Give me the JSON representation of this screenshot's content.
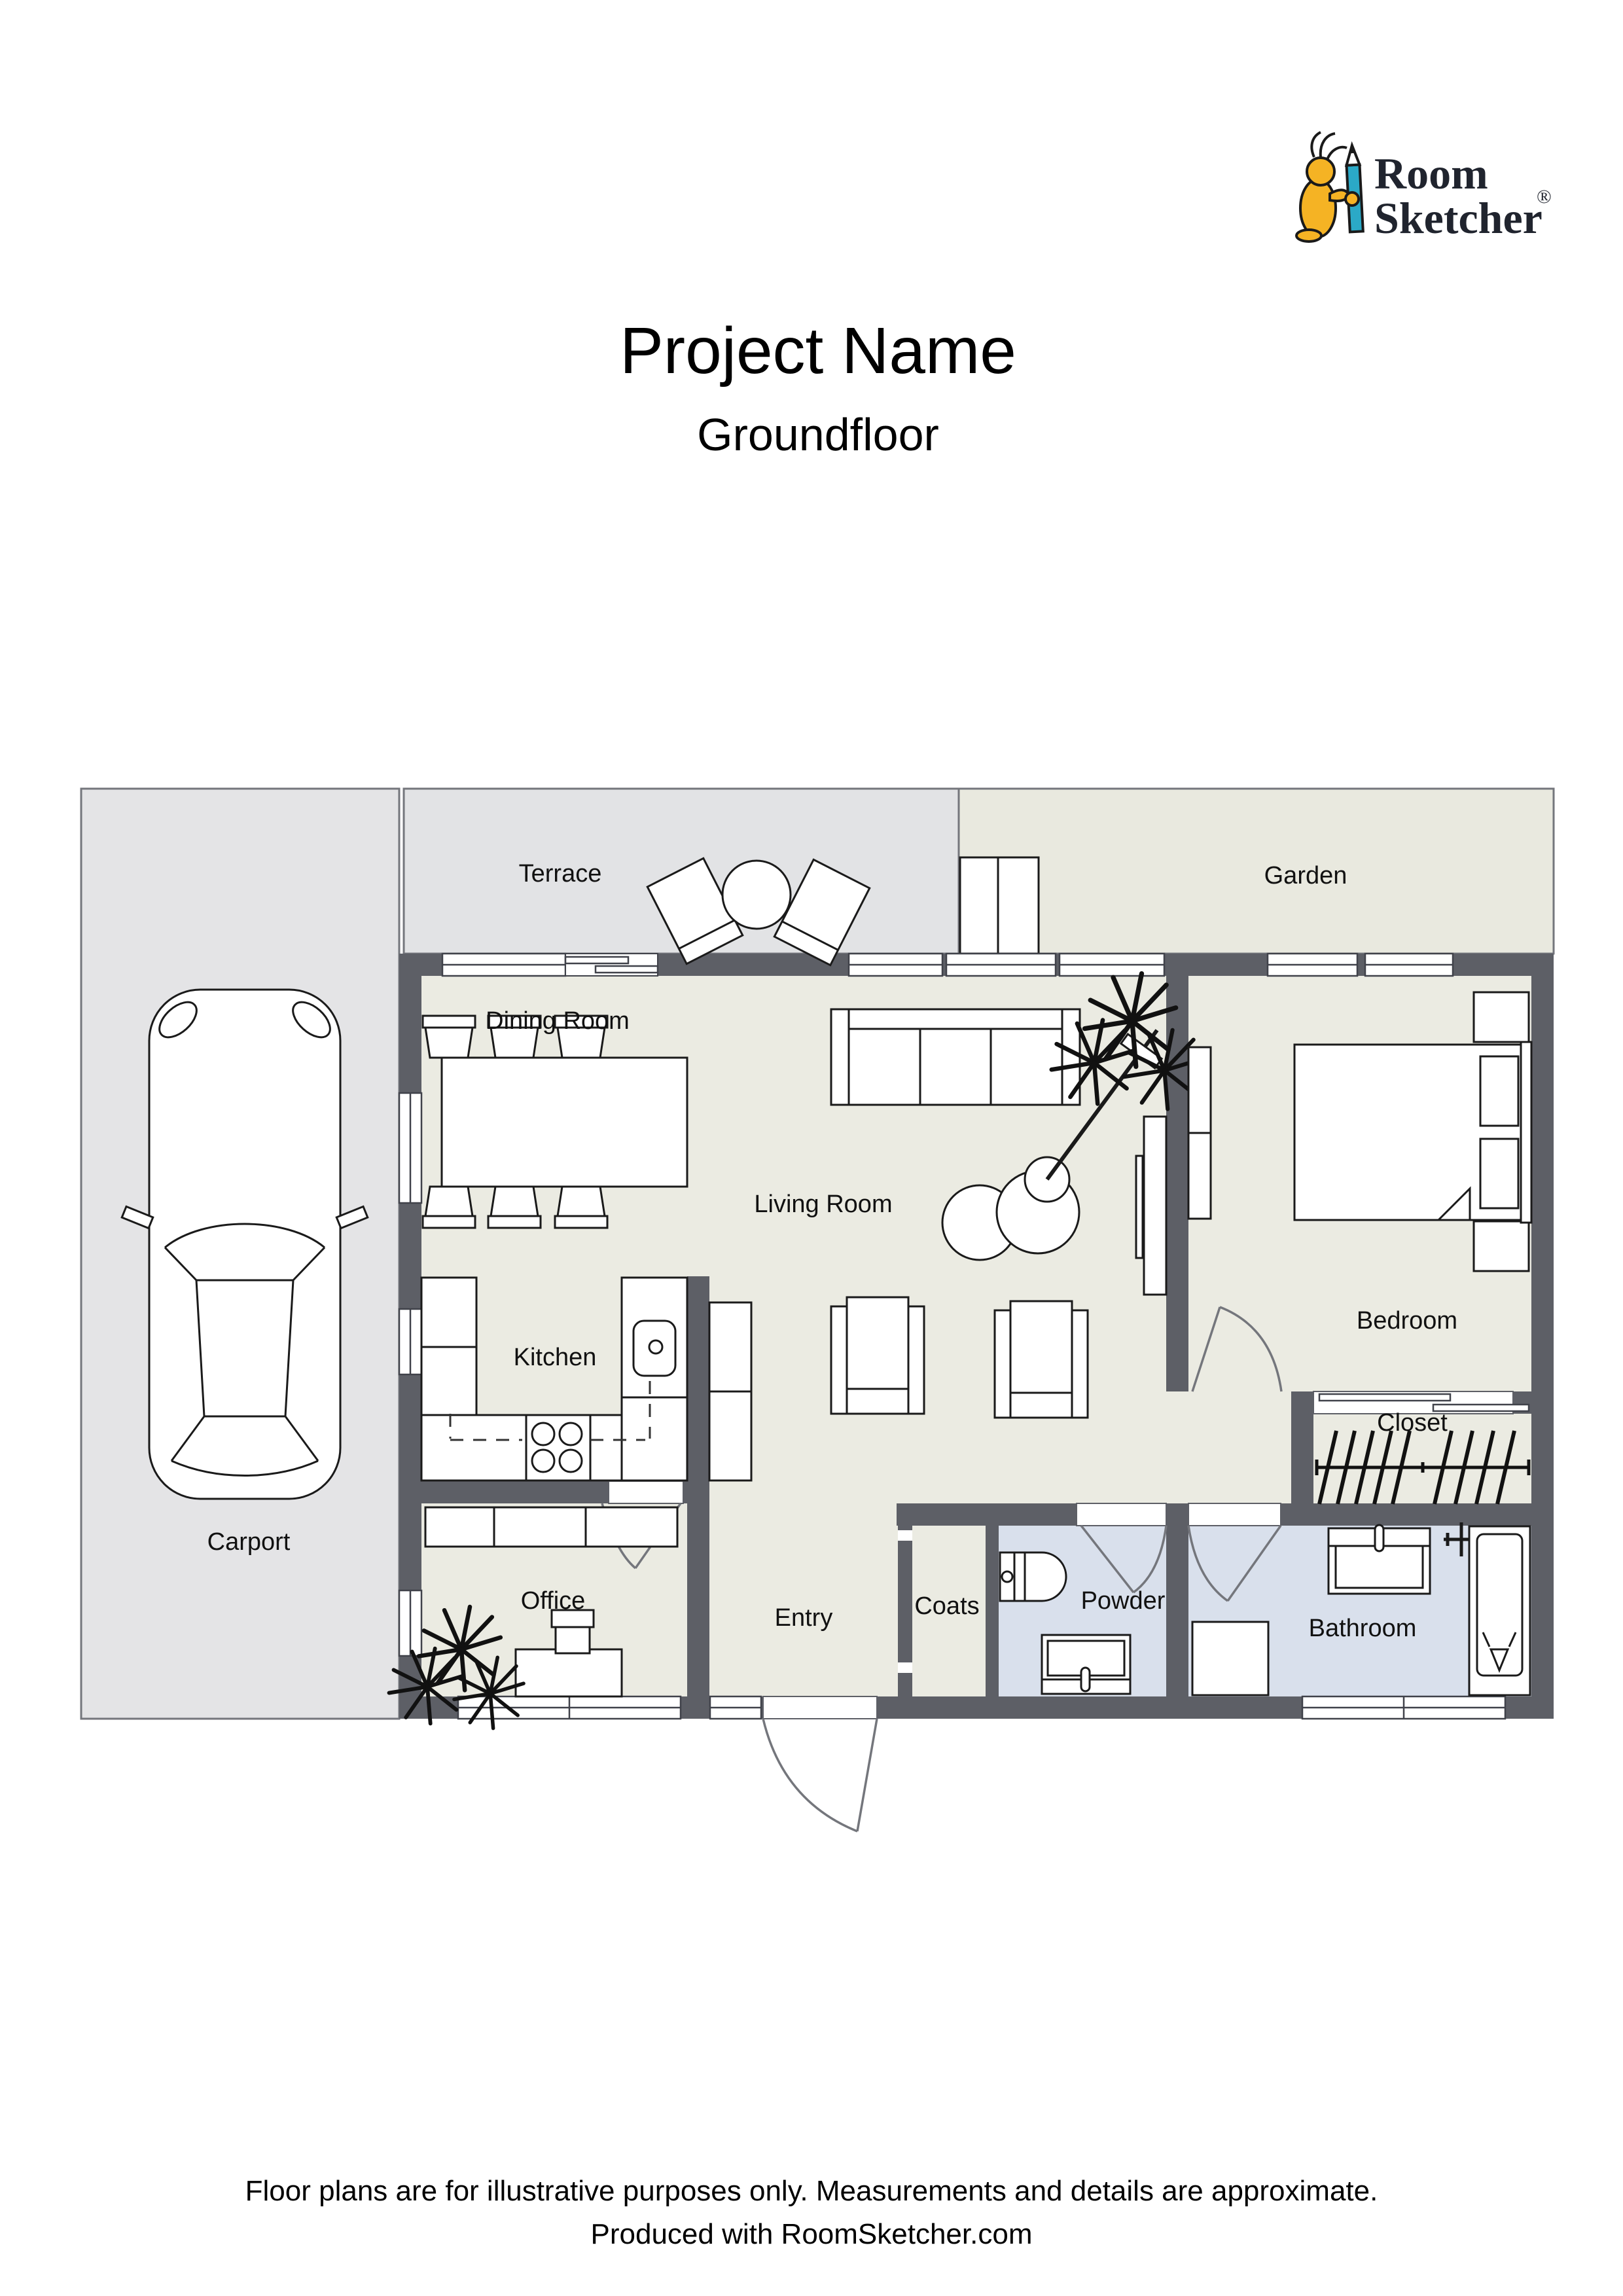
{
  "title": "Project Name",
  "subtitle": "Groundfloor",
  "logo": {
    "word1": "Room",
    "word2": "Sketcher",
    "registered": "®"
  },
  "rooms": {
    "terrace": "Terrace",
    "garden": "Garden",
    "dining_room": "Dining Room",
    "living_room": "Living Room",
    "bedroom": "Bedroom",
    "kitchen": "Kitchen",
    "closet": "Closet",
    "carport": "Carport",
    "office": "Office",
    "entry": "Entry",
    "coats": "Coats",
    "powder": "Powder",
    "bathroom": "Bathroom"
  },
  "footer": {
    "line1": "Floor plans are for illustrative purposes only. Measurements and details are approximate.",
    "line2": "Produced with RoomSketcher.com"
  },
  "colors": {
    "wall": "#5d5f66",
    "interior_floor": "#ebebe2",
    "wet_room_floor": "#d9e0ec",
    "carport_gray": "#e4e4e6",
    "terrace_gray": "#e2e3e5",
    "garden_green": "#e9e9df",
    "logo_yellow": "#f5b324",
    "logo_teal": "#2ba9c7"
  }
}
